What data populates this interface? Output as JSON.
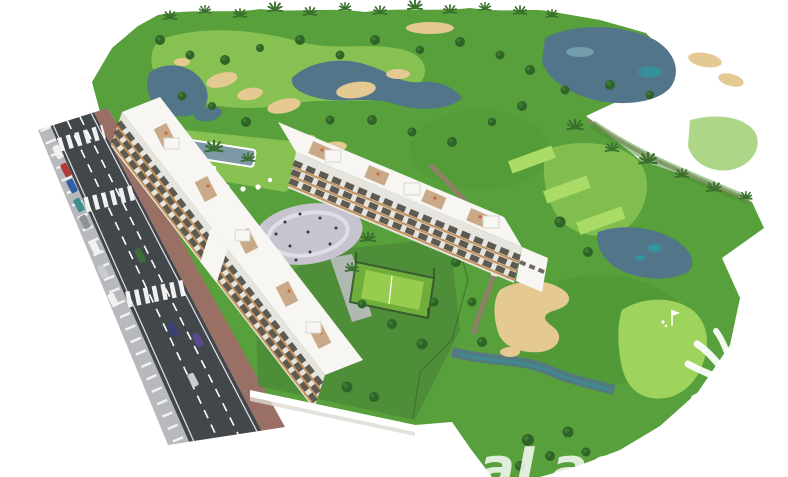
{
  "image": {
    "description": "Aerial 3D architectural rendering of a white apartment complex beside a golf course with lakes, sand bunkers, palm trees, a street with cars, a pool, a circular plaza and a paddle court",
    "width_px": 788,
    "height_px": 477
  },
  "watermark": {
    "text": "asaLasB",
    "logo": "palm-tree"
  },
  "colors": {
    "background": "#ffffff",
    "rough": "#57a03b",
    "rough_dark": "#4a8f31",
    "fairway": "#8cc455",
    "green": "#9ed45e",
    "tee": "#aadb66",
    "tree": "#2f6428",
    "tree_light": "#4c8a34",
    "palm": "#3b6f2d",
    "sand": "#e5c992",
    "lake": "#53758a",
    "lake_teal": "#2e9aa4",
    "lake_light": "#8ab7c6",
    "asphalt": "#42474c",
    "sidewalk": "#b7b9bd",
    "sidewalk_red": "#9a7065",
    "road_line": "#ffffff",
    "building": "#f7f6f2",
    "building_shade": "#e6e4de",
    "window": "#4a473f",
    "wood": "#c4935c",
    "deck": "#c9a987",
    "furniture": "#c96b3f",
    "plaza": "#c7c3cf",
    "plaza_ring": "#e0dde6",
    "court": "#6fae3a",
    "court_inner": "#97cc4e",
    "fence": "#33502e",
    "pool": "#7e98a6",
    "garden": "#4c8838",
    "path": "#9b7a72",
    "people": "#3a3a3a",
    "watermark": "#ffffff",
    "car_red": "#b33a35",
    "car_blue": "#2f5fa8",
    "car_teal": "#3e8f8a",
    "car_gray": "#8d9296",
    "car_white": "#f2f2f2",
    "car_navy": "#3a3f77",
    "car_silver": "#c9ccd0",
    "car_green": "#3e6b3a",
    "car_purple": "#5c4a8a"
  }
}
